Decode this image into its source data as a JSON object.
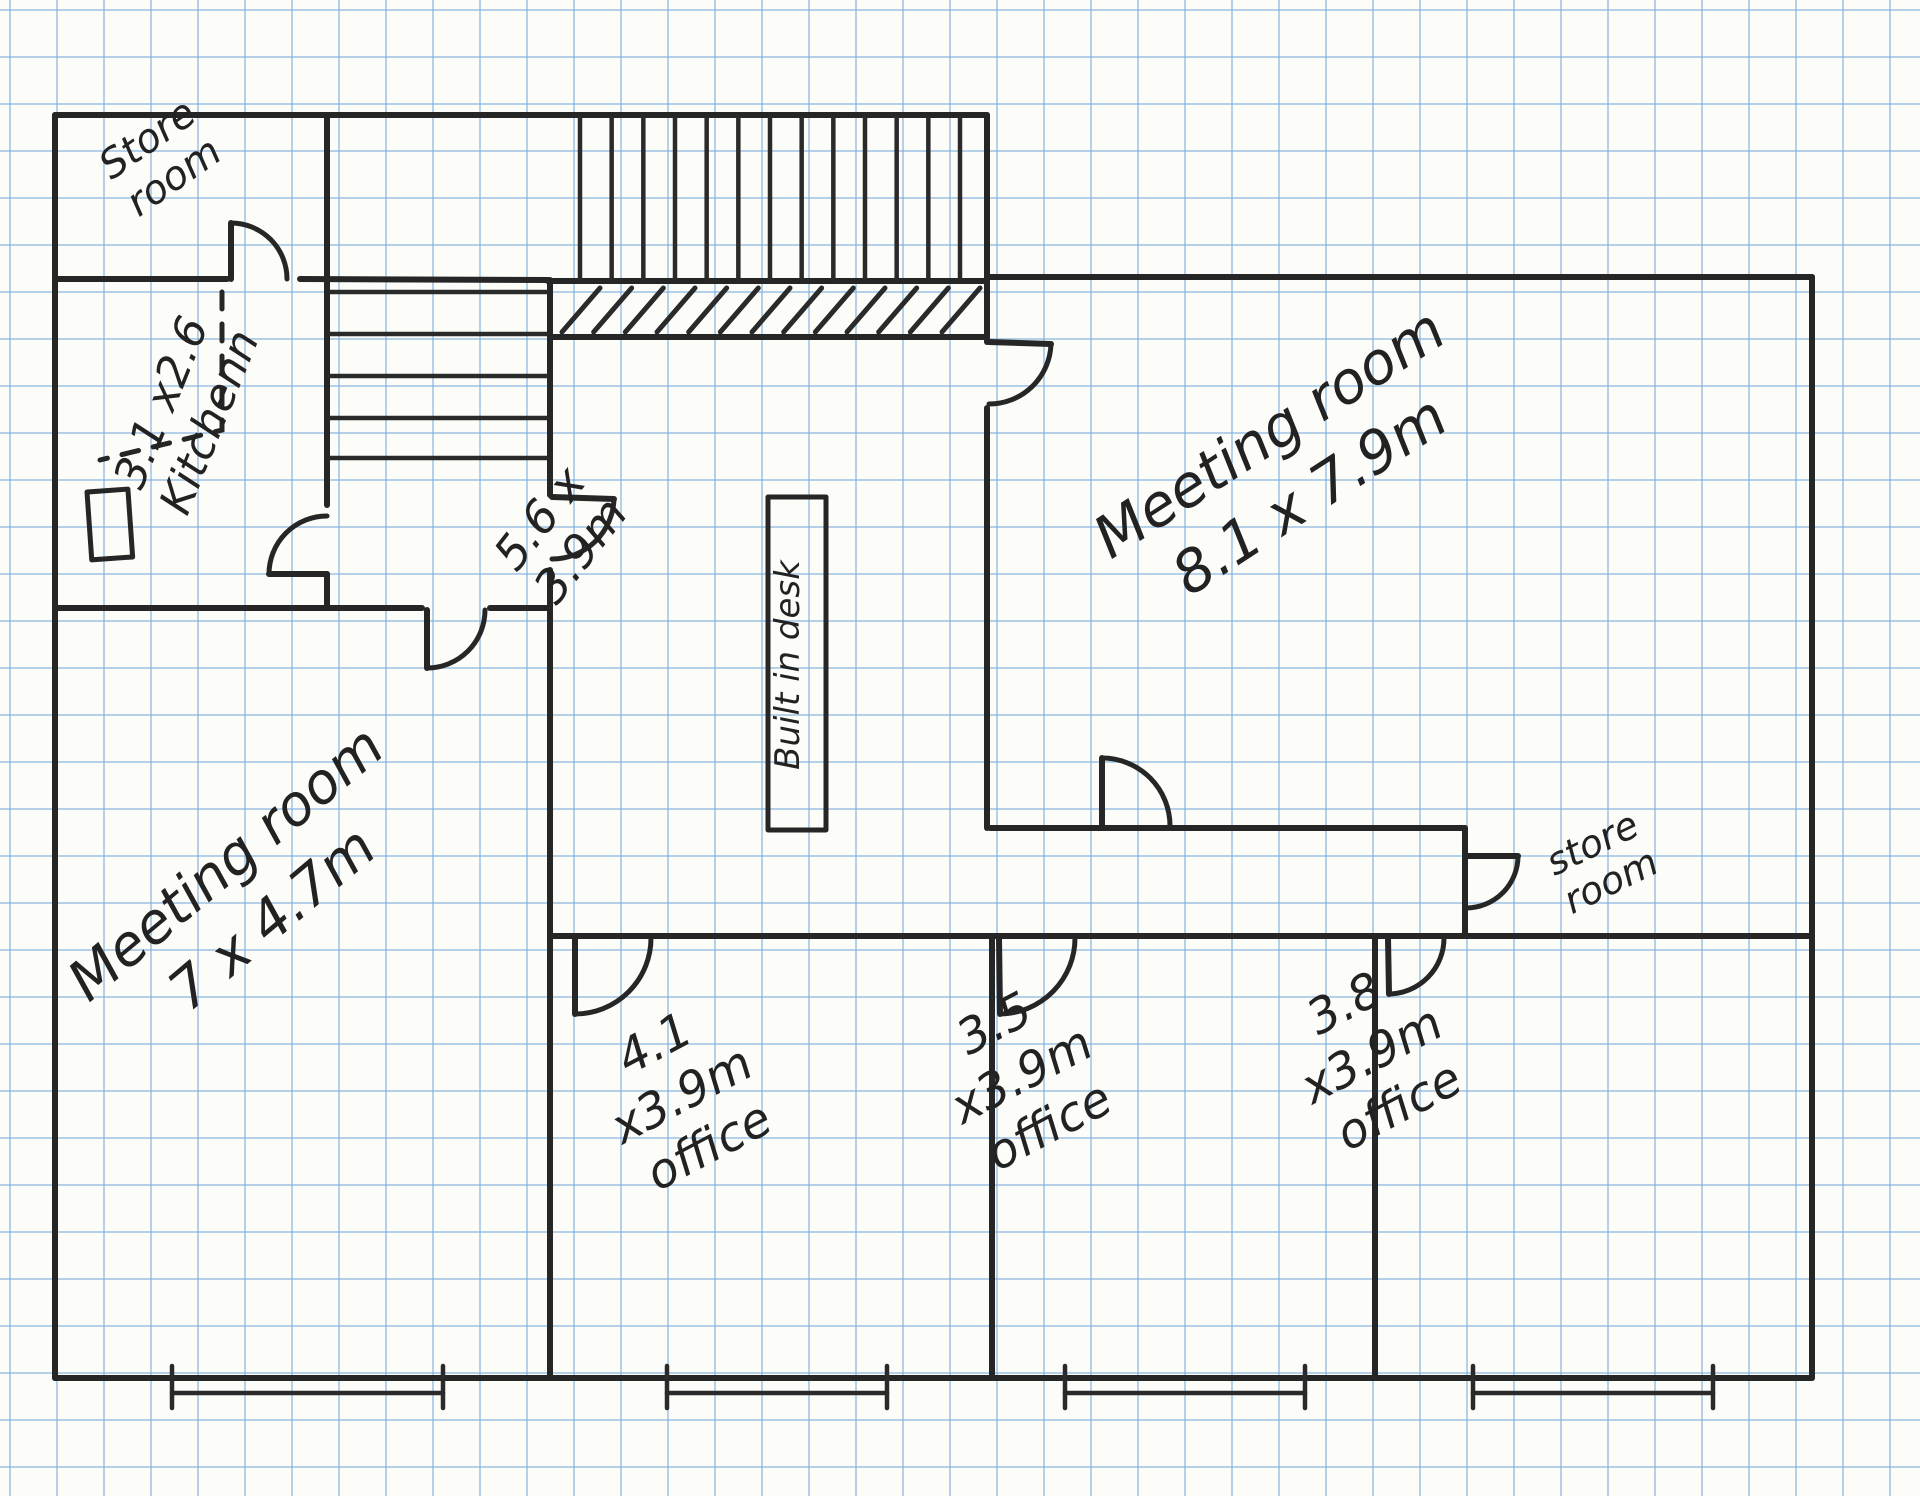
{
  "page": {
    "title": "Hand-drawn office floor plan sketch on graph paper"
  },
  "canvas": {
    "width": 1920,
    "height": 1496,
    "paper_color": "#fcfcf9",
    "grid_color": "#7aaddc",
    "grid_size_px": 47,
    "ink_color": "#262626"
  },
  "rooms": [
    {
      "name": "Store room (top left)",
      "dimensions": ""
    },
    {
      "name": "Kitchen",
      "dimensions": "3.1 x2.6"
    },
    {
      "name": "Staircase with landing",
      "dimensions": ""
    },
    {
      "name": "Room with built in desk",
      "dimensions": "5.6 x 3.9m"
    },
    {
      "name": "Meeting room (large)",
      "dimensions": "8.1 x 7.9m"
    },
    {
      "name": "Store room (right)",
      "dimensions": ""
    },
    {
      "name": "Meeting room (lower left)",
      "dimensions": "7 x 4.7m"
    },
    {
      "name": "Office 1",
      "dimensions": "4.1 x3.9m"
    },
    {
      "name": "Office 2",
      "dimensions": "3.5 x3.9m"
    },
    {
      "name": "Office 3",
      "dimensions": "3.8 x3.9m"
    }
  ],
  "plan": {
    "walls": [
      [
        55,
        115,
        987,
        115
      ],
      [
        55,
        115,
        55,
        1378
      ],
      [
        55,
        1378,
        1812,
        1378
      ],
      [
        1812,
        277,
        1812,
        1378
      ],
      [
        987,
        277,
        1812,
        277
      ],
      [
        987,
        115,
        987,
        342
      ],
      [
        987,
        408,
        987,
        828
      ],
      [
        55,
        279,
        227,
        279
      ],
      [
        300,
        279,
        548,
        280
      ],
      [
        548,
        281,
        987,
        281
      ],
      [
        327,
        115,
        327,
        279
      ],
      [
        327,
        279,
        327,
        505
      ],
      [
        327,
        574,
        327,
        608
      ],
      [
        55,
        608,
        422,
        608
      ],
      [
        490,
        608,
        550,
        608
      ],
      [
        550,
        280,
        550,
        495
      ],
      [
        550,
        570,
        550,
        1378
      ],
      [
        550,
        337,
        987,
        337
      ],
      [
        990,
        828,
        1465,
        828
      ],
      [
        550,
        936,
        1812,
        936
      ],
      [
        1465,
        828,
        1465,
        936
      ],
      [
        992,
        936,
        992,
        1378
      ],
      [
        1375,
        936,
        1375,
        1378
      ]
    ],
    "stairs": {
      "upper": {
        "x1": 580,
        "x2": 960,
        "count": 13,
        "y1": 118,
        "y2": 279
      },
      "lower": {
        "y_lines": [
          292,
          334,
          376,
          418,
          458
        ],
        "x1": 330,
        "x2": 547
      }
    },
    "hatch": {
      "x1": 562,
      "x2": 942,
      "count": 13,
      "y_bottom": 332,
      "y_top": 288,
      "dx": 38
    },
    "desk": {
      "x": 768,
      "y": 497,
      "w": 58,
      "h": 333
    },
    "kitchen_fixture": {
      "x": 87,
      "y": 492,
      "w": 41,
      "h": 68
    },
    "dashed_lines": [
      {
        "points": "222,292 222,430 100,460"
      }
    ],
    "doors": [
      {
        "name": "store-room-top-left",
        "leaf": [
          231,
          279,
          231,
          223
        ],
        "arc": "M 231 223 A 56 56 0 0 1 287 279"
      },
      {
        "name": "kitchen",
        "leaf": [
          327,
          574,
          269,
          574
        ],
        "arc": "M 269 574 A 58 58 0 0 1 327 516"
      },
      {
        "name": "meeting-room-7",
        "leaf": [
          427,
          610,
          427,
          668
        ],
        "arc": "M 427 668 A 58 58 0 0 0 485 610"
      },
      {
        "name": "room-5-6",
        "leaf": [
          552,
          497,
          614,
          499
        ],
        "arc": "M 614 499 A 62 62 0 0 1 552 559"
      },
      {
        "name": "meeting-room-8-upper",
        "leaf": [
          989,
          342,
          1051,
          344
        ],
        "arc": "M 1051 344 A 62 62 0 0 1 989 404"
      },
      {
        "name": "meeting-room-8-lower",
        "leaf": [
          1102,
          826,
          1102,
          758
        ],
        "arc": "M 1102 758 A 68 68 0 0 1 1170 826"
      },
      {
        "name": "store-room-right",
        "leaf": [
          1466,
          856,
          1518,
          856
        ],
        "arc": "M 1518 856 A 52 52 0 0 1 1466 908"
      },
      {
        "name": "office-4-1",
        "leaf": [
          575,
          938,
          575,
          1014
        ],
        "arc": "M 575 1014 A 76 76 0 0 0 651 938"
      },
      {
        "name": "office-3-5",
        "leaf": [
          999,
          938,
          1000,
          1014
        ],
        "arc": "M 1000 1014 A 76 76 0 0 0 1075 938"
      },
      {
        "name": "office-3-8",
        "leaf": [
          1388,
          938,
          1389,
          994
        ],
        "arc": "M 1389 994 A 56 56 0 0 0 1444 938"
      }
    ],
    "windows": {
      "y_line": 1393,
      "tick_y1": 1366,
      "tick_y2": 1408,
      "spans": [
        [
          172,
          443
        ],
        [
          667,
          887
        ],
        [
          1065,
          1305
        ],
        [
          1473,
          1713
        ]
      ]
    },
    "labels": [
      {
        "name": "store-room-top-left-label",
        "lines": [
          "Store",
          "room"
        ],
        "x": 155,
        "y": 150,
        "rot": -35,
        "size": 40,
        "lh": 46
      },
      {
        "name": "kitchen-label",
        "lines": [
          "3.1 x2.6",
          "Kitchenn"
        ],
        "x": 175,
        "y": 408,
        "rot": -68,
        "size": 44,
        "lh": 52
      },
      {
        "name": "room-5-6-label",
        "lines": [
          "5.6 x",
          "3.9m"
        ],
        "x": 552,
        "y": 528,
        "rot": -52,
        "size": 46,
        "lh": 52
      },
      {
        "name": "built-in-desk-label",
        "lines": [
          "Built in desk"
        ],
        "x": 799,
        "y": 665,
        "rot": -90,
        "size": 34,
        "lh": 38
      },
      {
        "name": "meeting-room-8-label",
        "lines": [
          "Meeting room",
          "8.1 x 7.9m"
        ],
        "x": 1280,
        "y": 450,
        "rot": -33,
        "size": 58,
        "lh": 74
      },
      {
        "name": "store-room-right-label",
        "lines": [
          "store",
          "room"
        ],
        "x": 1598,
        "y": 855,
        "rot": -26,
        "size": 38,
        "lh": 42
      },
      {
        "name": "meeting-room-7-label",
        "lines": [
          "Meeting room",
          "7 x 4.7m"
        ],
        "x": 238,
        "y": 878,
        "rot": -40,
        "size": 56,
        "lh": 72
      },
      {
        "name": "office-4-1-label",
        "lines": [
          "4.1",
          "x3.9m",
          "office"
        ],
        "x": 662,
        "y": 1058,
        "rot": -28,
        "size": 48,
        "lh": 58
      },
      {
        "name": "office-3-5-label",
        "lines": [
          "3.5",
          "x3.9m",
          "office"
        ],
        "x": 1002,
        "y": 1038,
        "rot": -28,
        "size": 48,
        "lh": 58
      },
      {
        "name": "office-3-8-label",
        "lines": [
          "3.8",
          "x3.9m",
          "office"
        ],
        "x": 1352,
        "y": 1018,
        "rot": -28,
        "size": 48,
        "lh": 58
      }
    ]
  }
}
